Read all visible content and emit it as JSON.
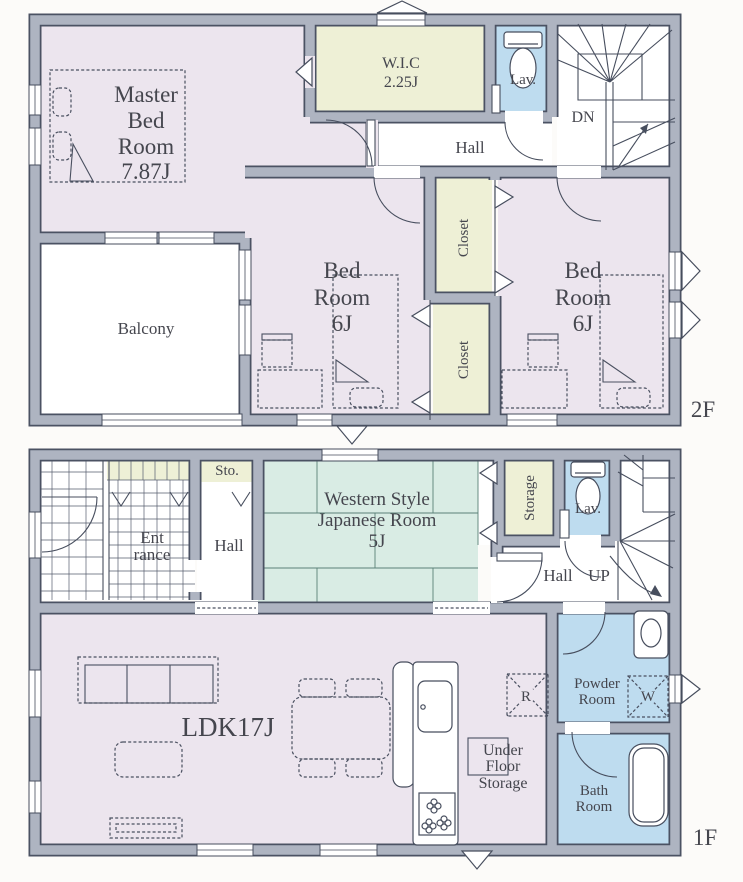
{
  "title": "House floor plan",
  "colors": {
    "wall_fill": "#aeb4c1",
    "wall_edge": "#4b5263",
    "line": "#474e5e",
    "room_lavender": "#ece5ee",
    "room_yellow": "#eef0d6",
    "room_blue": "#bedcef",
    "room_mint": "#d9ece4",
    "white": "#ffffff",
    "text": "#45464e"
  },
  "floors": {
    "f2": {
      "tag": "2F",
      "rooms": {
        "master": {
          "lines": [
            "Master",
            "Bed",
            "Room",
            "7.87J"
          ]
        },
        "wic": {
          "lines": [
            "W.I.C",
            "2.25J"
          ]
        },
        "lav": "Lav.",
        "hall": "Hall",
        "dn": "DN",
        "closet_top": "Closet",
        "closet_bottom": "Closet",
        "bedroom_left": {
          "lines": [
            "Bed",
            "Room",
            "6J"
          ]
        },
        "bedroom_right": {
          "lines": [
            "Bed",
            "Room",
            "6J"
          ]
        },
        "balcony": "Balcony"
      }
    },
    "f1": {
      "tag": "1F",
      "rooms": {
        "storage_small": "Sto.",
        "entrance": {
          "lines": [
            "Ent",
            "rance"
          ]
        },
        "hall": "Hall",
        "japanese": {
          "lines": [
            "Western Style",
            "Japanese Room",
            "5J"
          ]
        },
        "storage": "Storage",
        "lav": "Lav.",
        "hall2": "Hall",
        "up": "UP",
        "ldk": "LDK17J",
        "refrigerator": "R",
        "under_floor": {
          "lines": [
            "Under",
            "Floor",
            "Storage"
          ]
        },
        "powder": {
          "lines": [
            "Powder",
            "Room"
          ]
        },
        "washer": "W",
        "bath": {
          "lines": [
            "Bath",
            "Room"
          ]
        }
      }
    }
  }
}
